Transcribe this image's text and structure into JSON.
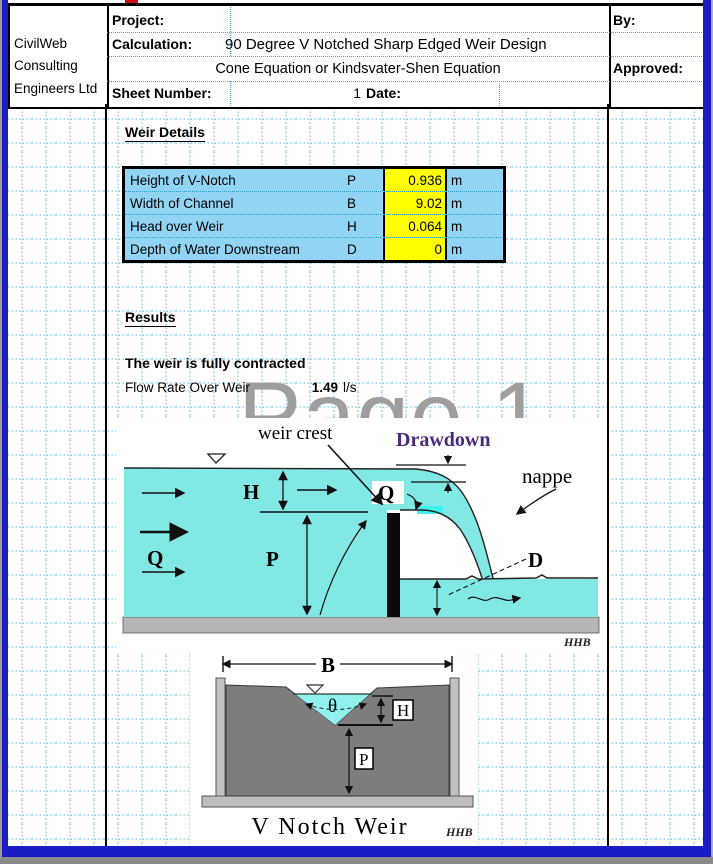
{
  "watermark": "Page 1",
  "header": {
    "company_line1": "CivilWeb",
    "company_line2": "Consulting",
    "company_line3": "Engineers Ltd",
    "project_label": "Project:",
    "calculation_label": "Calculation:",
    "calculation_value": "90 Degree V Notched Sharp Edged Weir Design",
    "method_line": "Cone Equation or Kindsvater-Shen Equation",
    "sheet_number_label": "Sheet Number:",
    "sheet_number_value": "1",
    "date_label": "Date:",
    "by_label": "By:",
    "approved_label": "Approved:"
  },
  "weir_details": {
    "title": "Weir Details",
    "rows": [
      {
        "label": "Height of V-Notch",
        "symbol": "P",
        "value": "0.936",
        "unit": "m"
      },
      {
        "label": "Width of Channel",
        "symbol": "B",
        "value": "9.02",
        "unit": "m"
      },
      {
        "label": "Head over Weir",
        "symbol": "H",
        "value": "0.064",
        "unit": "m"
      },
      {
        "label": "Depth of Water Downstream",
        "symbol": "D",
        "value": "0",
        "unit": "m"
      }
    ],
    "input_fill_color": "#ffff00",
    "table_fill_color": "#92d4f3"
  },
  "results": {
    "title": "Results",
    "status_text": "The weir is fully contracted",
    "flow_label": "Flow Rate Over Weir",
    "flow_value": "1.49",
    "flow_unit": "l/s"
  },
  "diagram_section": {
    "weir_crest": "weir crest",
    "drawdown": "Drawdown",
    "nappe": "nappe",
    "h_label": "H",
    "p_label": "P",
    "q_upstream": "Q",
    "q_over_weir": "Q",
    "d_label": "D",
    "signature": "HHB",
    "drawdown_color": "#4a2a7d",
    "water_color": "#82e8e3"
  },
  "diagram_front": {
    "caption": "V Notch Weir",
    "b_label": "B",
    "theta_label": "θ",
    "h_label": "H",
    "p_label": "P",
    "signature": "HHB"
  },
  "frame": {
    "border_color": "#1c1cc4"
  }
}
